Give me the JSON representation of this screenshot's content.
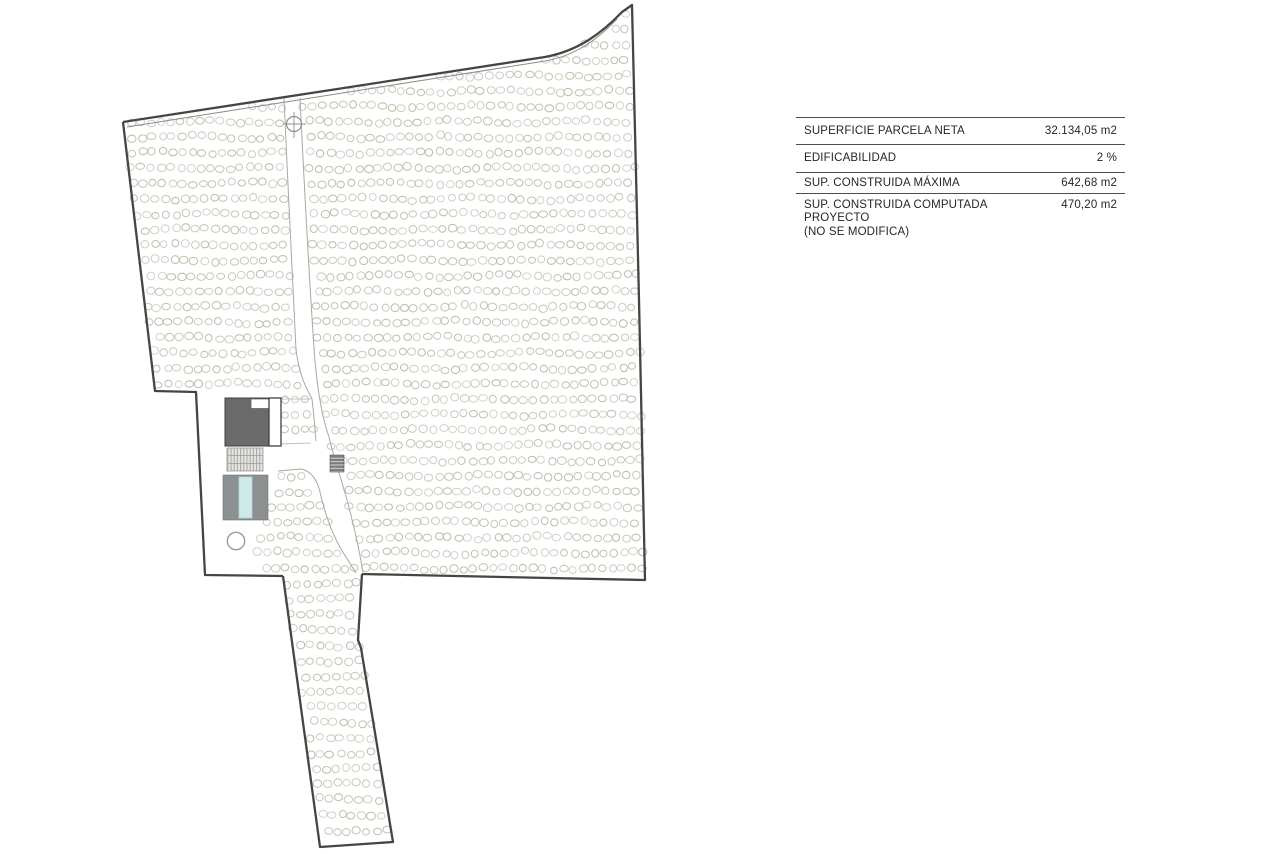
{
  "page": {
    "kind": "architectural site plan",
    "background_color": "#ffffff"
  },
  "summary_table": {
    "rows": [
      {
        "label": "SUPERFICIE PARCELA NETA",
        "sublabel": "",
        "value": "32.134,05 m2"
      },
      {
        "label": "EDIFICABILIDAD",
        "sublabel": "",
        "value": "2 %"
      },
      {
        "label": "SUP. CONSTRUIDA MÁXIMA",
        "sublabel": "",
        "value": "642,68 m2"
      },
      {
        "label": "SUP. CONSTRUIDA COMPUTADA PROYECTO",
        "sublabel": "(NO SE MODIFICA)",
        "value": "470,20 m2"
      }
    ]
  },
  "site_plan": {
    "features": {
      "parcel_boundary": "irregular parcel outline with narrow access strip at bottom",
      "olive_grove": "rows of small tree circles filling the parcel",
      "access_path": "untreed path from top boundary curving to the access strip",
      "main_building": "dark grey building with white annex",
      "deck": "striped terrace below building",
      "pool": "grey pool deck with light blue pool",
      "water_tank": "small outlined circle below pool",
      "utility_box": "small hatched rectangle beside path",
      "entrance_marker": "small crossed circle at top of path"
    },
    "colors": {
      "boundary": "#454545",
      "boundary_inner_line": "#8a8a8a",
      "tree_outline": "#bcbcac",
      "path_edge": "#a9a9a0",
      "building_fill": "#6b6b6b",
      "annex_fill": "#ffffff",
      "deck_fill": "#e4e4de",
      "deck_stripe": "#9a9a9a",
      "pool_deck": "#8d9090",
      "pool_water": "#cfe9e9",
      "utility_fill": "#7a7a7a",
      "utility_stripe": "#dcdcdc",
      "circle_outline": "#9b9b9b",
      "table_rule": "#4d4d4d",
      "table_text": "#262626"
    }
  }
}
